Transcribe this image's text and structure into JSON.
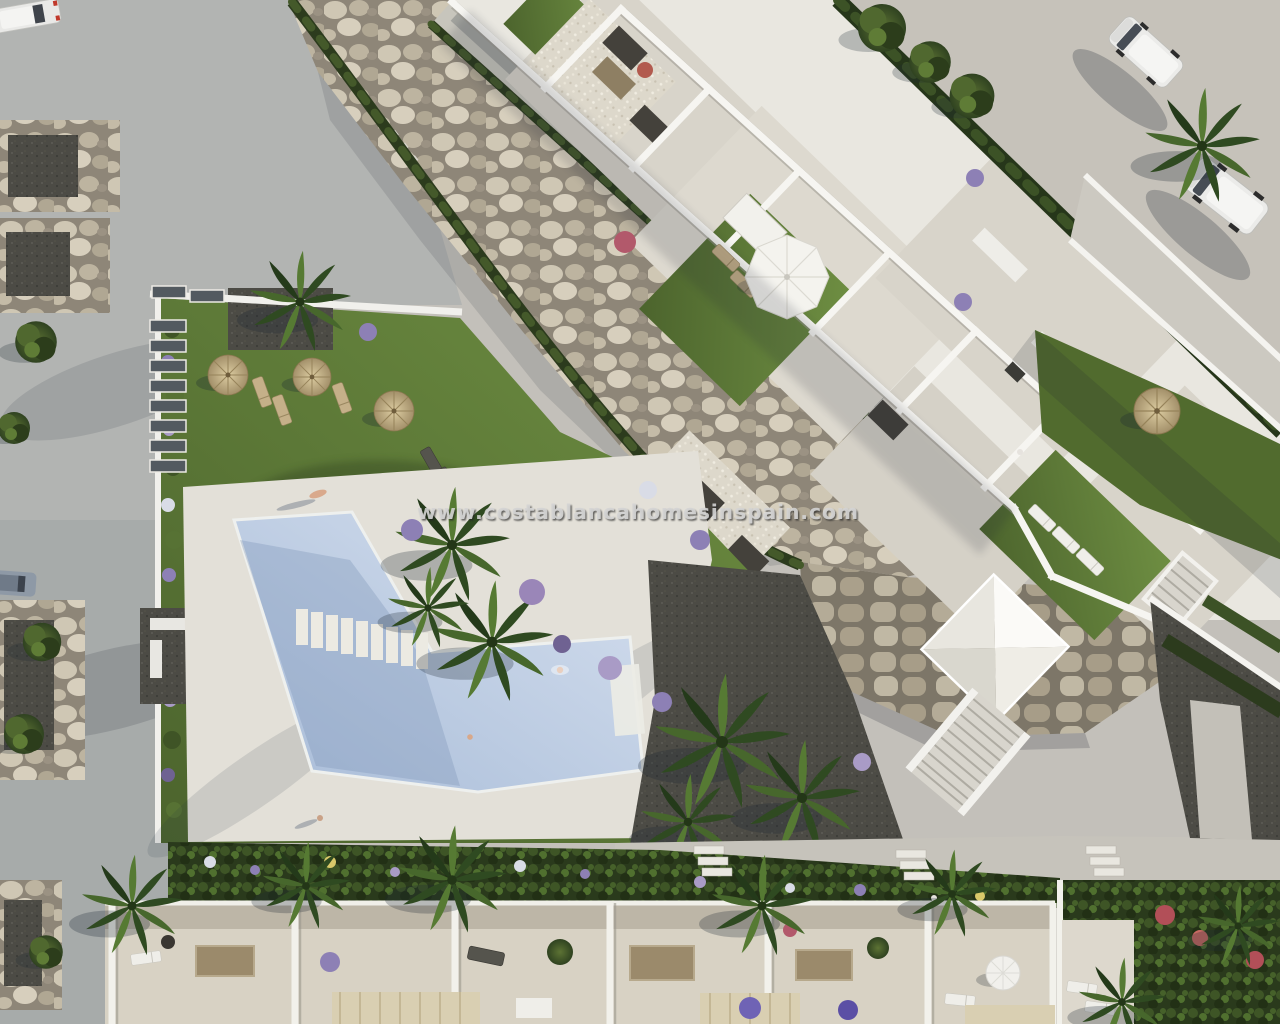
{
  "watermark": {
    "text": "www.costablancahomesinspain.com"
  },
  "scene": {
    "type": "aerial-3d-architecture-render",
    "description": "Top-down render of a new-build residential complex: white apartment block with roof terraces and lawns on a diagonal, landscaped rock slope, communal garden with straw parasols, angled swimming pool on a sun deck, access road with parking bays, two white vans, and a row of townhouse terraces along the bottom.",
    "areas": {
      "access_road": {
        "label": "access road with stone parking bays"
      },
      "rock_garden": {
        "label": "landscaped rock slope with hedges"
      },
      "apartment_block": {
        "label": "white apartment block with roof terraces"
      },
      "pool_garden": {
        "label": "communal lawn with straw parasols and loungers"
      },
      "pool": {
        "label": "communal swimming pool"
      },
      "sun_deck": {
        "label": "pool sun deck"
      },
      "townhouses": {
        "label": "townhouse roof terraces with pergolas"
      },
      "driveway": {
        "label": "side driveway with parked vans"
      }
    },
    "counts": {
      "straw_parasols": 6,
      "white_parasols": 1,
      "dome_parasols": 1,
      "vans": 2,
      "cars": 2,
      "pools": 1,
      "staircases": 2
    }
  },
  "palette": {
    "pavement": "#c3c0ba",
    "road": "#b2b4b2",
    "building_white": "#e9e7e0",
    "wall_white": "#f6f5f1",
    "terrace_tile": "#d8d4ca",
    "walkway": "#c7c5bc",
    "lawn_light": "#6e8e42",
    "lawn_dark": "#4c642d",
    "hedge": "#2c3b1d",
    "rock_base": "#8e8678",
    "rock_light": "#cfc7b4",
    "stone_wall": "#a89e8a",
    "gravel_dark": "#4c4b45",
    "pool_light": "#d6e0ef",
    "pool_dark": "#a8bcd8",
    "deck": "#e3e0d8",
    "townhouse_floor": "#d8d2c4",
    "umbrella_straw": "#c9b685",
    "parasol_white": "#f4f3ee",
    "pergola": "#d9cfb2",
    "flower_purple": "#8d80b5",
    "flower_red": "#b2596b",
    "watermark_fill": "#d4d4d4"
  }
}
